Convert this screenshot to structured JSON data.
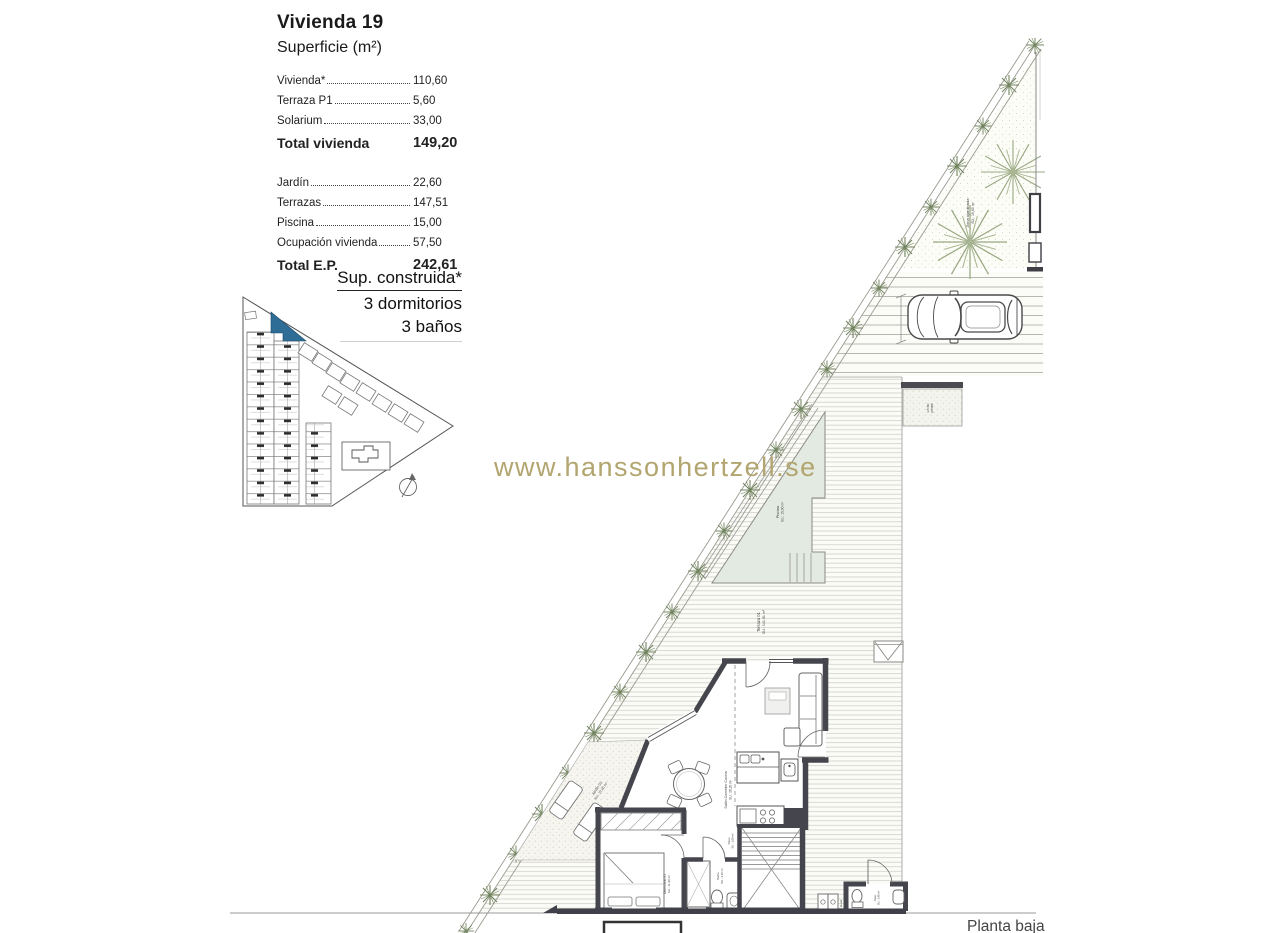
{
  "info": {
    "title": "Vivienda 19",
    "subtitle": "Superficie (m²)",
    "rows": [
      {
        "label": "Vivienda*",
        "value": "110,60"
      },
      {
        "label": "Terraza P1",
        "value": "5,60"
      },
      {
        "label": "Solarium",
        "value": "33,00"
      }
    ],
    "total1": {
      "label": "Total vivienda",
      "value": "149,20"
    },
    "rows2": [
      {
        "label": "Jardín",
        "value": "22,60"
      },
      {
        "label": "Terrazas",
        "value": "147,51"
      },
      {
        "label": "Piscina",
        "value": "15,00"
      },
      {
        "label": "Ocupación vivienda",
        "value": "57,50"
      }
    ],
    "total2": {
      "label": "Total E.P.",
      "value": "242,61"
    }
  },
  "spec": {
    "line1": "Sup. construida*",
    "line2": "3 dormitorios",
    "line3": "3 baños"
  },
  "watermark": "www.hanssonhertzell.se",
  "plan": {
    "floor_label": "Planta baja",
    "labels": {
      "terraza": "Terraza 01",
      "terraza_area": "SU.: 141,91 m²",
      "piscina": "Piscina",
      "piscina_area": "SU.: 15,00 m²",
      "salon": "Salón Comedor Cocina",
      "salon_area": "SU.: 28,20 m²",
      "dormitorio": "Dormitorio 01",
      "dormitorio_area": "SU.: 11,90 m²",
      "bano": "Baño",
      "bano_area": "SU.: 4,35 m²",
      "paso": "Paso",
      "paso_area": "SU.: 1,06 m²",
      "aseo": "Aseo",
      "aseo_area": "SU.: 1,96 m²",
      "lavadero": "lavad.",
      "jardin": "Jardín 01",
      "jardin_area": "SU.: 22,60 m²",
      "zona": "Zona ajardinada",
      "zona_area": "SU.: 16,60 m²",
      "piedra_l1": "Lecho",
      "piedra_l2": "piedra"
    },
    "colors": {
      "wall": "#45454d",
      "pool_fill": "#e3eae2",
      "hedge_green": "#72855f",
      "highlight_blue": "#2e6d96",
      "watermark_gold": "#b2a56f"
    }
  }
}
